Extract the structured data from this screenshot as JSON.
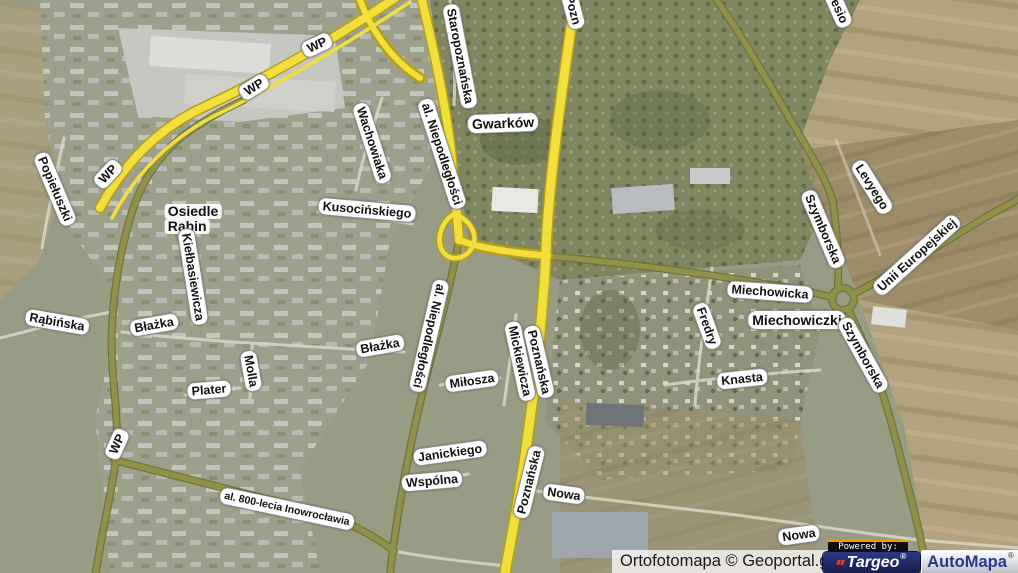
{
  "map": {
    "attribution": "Ortofotomapa © Geoportal.gov.pl",
    "branding": {
      "powered_by": "Powered by:",
      "targeo": "Targeo",
      "targeo_reg": "®",
      "automapa": "AutoMapa",
      "automapa_reg": "®"
    },
    "colors": {
      "road_primary": "#f2df3d",
      "road_primary_casing": "#b6a013",
      "road_secondary": "#90914a",
      "road_secondary_casing": "#6e7034",
      "road_minor": "#d8d8c8",
      "label_bg": "#ffffff",
      "label_text": "#111111",
      "powered_orange": "#f59a00",
      "targeo_navy": "#1c2460",
      "automapa_blue": "#28388f"
    },
    "labels": [
      {
        "text": "WP",
        "x": 317,
        "y": 45,
        "r": -25,
        "type": "route"
      },
      {
        "text": "WP",
        "x": 254,
        "y": 87,
        "r": -32,
        "type": "route"
      },
      {
        "text": "WP",
        "x": 108,
        "y": 174,
        "r": -47,
        "type": "route"
      },
      {
        "text": "WP",
        "x": 117,
        "y": 444,
        "r": -66,
        "type": "route"
      },
      {
        "text": "Popiełuszki",
        "x": 55,
        "y": 189,
        "r": 67,
        "type": "street"
      },
      {
        "text": "Osiedle Rąbin",
        "lines": [
          "Osiedle",
          "Rąbin"
        ],
        "x": 193,
        "y": 219,
        "r": 0,
        "type": "area2"
      },
      {
        "text": "Kiełbasiewicza",
        "x": 193,
        "y": 277,
        "r": 81,
        "type": "street"
      },
      {
        "text": "Rąbińska",
        "x": 57,
        "y": 322,
        "r": 10,
        "type": "street"
      },
      {
        "text": "Błażka",
        "x": 154,
        "y": 325,
        "r": -10,
        "type": "street"
      },
      {
        "text": "Błażka",
        "x": 380,
        "y": 346,
        "r": -10,
        "type": "street"
      },
      {
        "text": "Molla",
        "x": 251,
        "y": 371,
        "r": 80,
        "type": "street"
      },
      {
        "text": "Plater",
        "x": 209,
        "y": 390,
        "r": -5,
        "type": "street"
      },
      {
        "text": "al. 800-lecia Inowrocławia",
        "x": 287,
        "y": 509,
        "r": 12,
        "type": "street",
        "size": 10.5
      },
      {
        "text": "Wachowiaka",
        "x": 372,
        "y": 143,
        "r": 72,
        "type": "street"
      },
      {
        "text": "Kusocińskiego",
        "x": 367,
        "y": 210,
        "r": 5,
        "type": "street"
      },
      {
        "text": "Staropoznańska",
        "x": 460,
        "y": 56,
        "r": 79,
        "type": "street"
      },
      {
        "text": "al. Niepodległości",
        "x": 442,
        "y": 154,
        "r": 72,
        "type": "street"
      },
      {
        "text": "al. Niepodległości",
        "x": 429,
        "y": 336,
        "r": 103,
        "type": "street"
      },
      {
        "text": "Gwarków",
        "x": 503,
        "y": 123,
        "r": -2,
        "type": "area"
      },
      {
        "text": "Pozn",
        "x": 573,
        "y": 10,
        "r": 75,
        "type": "street"
      },
      {
        "text": "Jesio",
        "x": 838,
        "y": 8,
        "r": 66,
        "type": "street"
      },
      {
        "text": "Levyego",
        "x": 872,
        "y": 187,
        "r": 58,
        "type": "street"
      },
      {
        "text": "Szymborska",
        "x": 823,
        "y": 229,
        "r": 67,
        "type": "street"
      },
      {
        "text": "Unii Europejskiej",
        "x": 917,
        "y": 255,
        "r": -42,
        "type": "street"
      },
      {
        "text": "Miechowicka",
        "x": 770,
        "y": 292,
        "r": 4,
        "type": "street"
      },
      {
        "text": "Miechowiczki",
        "x": 797,
        "y": 320,
        "r": 0,
        "type": "area"
      },
      {
        "text": "Fredry",
        "x": 707,
        "y": 326,
        "r": 70,
        "type": "street"
      },
      {
        "text": "Szymborska",
        "x": 863,
        "y": 355,
        "r": 61,
        "type": "street"
      },
      {
        "text": "Knasta",
        "x": 742,
        "y": 379,
        "r": -6,
        "type": "street"
      },
      {
        "text": "Mickiewicza",
        "x": 520,
        "y": 361,
        "r": 78,
        "type": "street"
      },
      {
        "text": "Poznańska",
        "x": 539,
        "y": 362,
        "r": 77,
        "type": "street"
      },
      {
        "text": "Miłosza",
        "x": 472,
        "y": 381,
        "r": -8,
        "type": "street"
      },
      {
        "text": "Poznańska",
        "x": 529,
        "y": 482,
        "r": -76,
        "type": "street"
      },
      {
        "text": "Janickiego",
        "x": 450,
        "y": 453,
        "r": -8,
        "type": "street"
      },
      {
        "text": "Wspólna",
        "x": 432,
        "y": 481,
        "r": -5,
        "type": "street"
      },
      {
        "text": "Nowa",
        "x": 564,
        "y": 494,
        "r": 8,
        "type": "street"
      },
      {
        "text": "Nowa",
        "x": 799,
        "y": 535,
        "r": -8,
        "type": "street"
      }
    ]
  }
}
